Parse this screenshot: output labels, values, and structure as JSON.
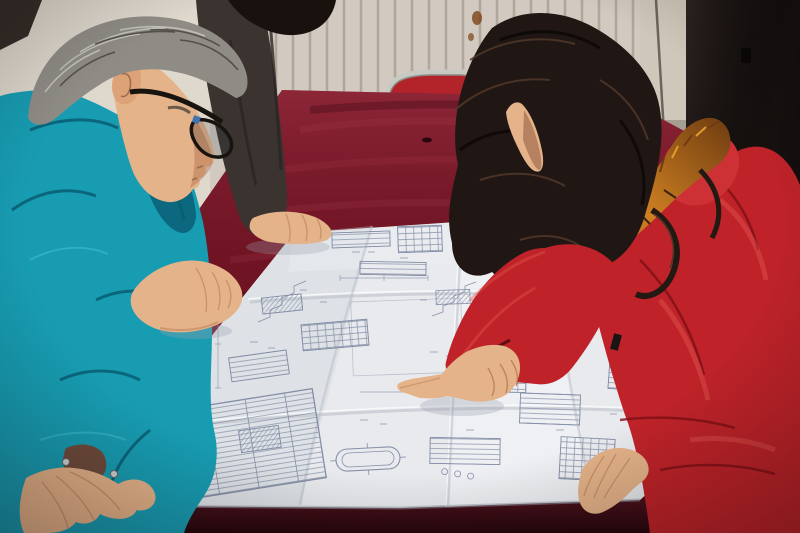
{
  "scene": {
    "kind": "photograph",
    "subjects": [
      "man in teal work jacket with glasses and gray hair",
      "woman in red down coat with fur-trimmed hood pointing at drawing",
      "partially visible third person in dark jacket resting a hand on the drawing",
      "large folded engineering blueprint spread on a dark red velvet table",
      "white radiator wall, chrome-framed red chair, dark door"
    ]
  },
  "palette": {
    "wall": "#ded8cd",
    "wall_groove": "#b2a99b",
    "door": "#16100f",
    "door_frame": "#cfc8ba",
    "latch": "#0a0807",
    "rust": "#7d4317",
    "chair_red": "#b2242a",
    "chair_chrome": "#c9c9c4",
    "velvet": "#6e1322",
    "velvet_front": "#4e0d19",
    "paper": "#e8eaee",
    "ink": "#7b86a0",
    "teal": "#189cb2",
    "teal_shadow": "#085d72",
    "man_hair": "#8f8c86",
    "skin": "#e5b389",
    "dark_jacket": "#3b3330",
    "hair_tuft": "#18110d",
    "woman_hair": "#201613",
    "fur": "#b46a1c",
    "coat_red": "#bf2329",
    "coat_bright": "#cd3136",
    "cuff_lining": "#6e4b3c",
    "snap": "#cfd2d4"
  }
}
